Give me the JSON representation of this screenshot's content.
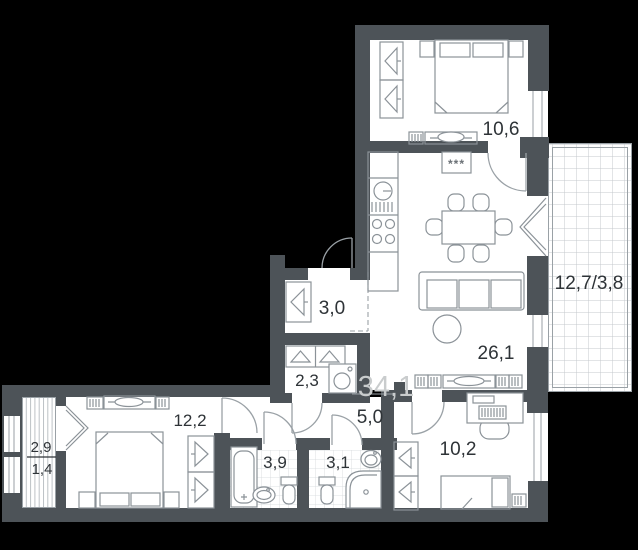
{
  "plan": {
    "title": "apartment-floor-plan",
    "total_area_label": "34,1",
    "labels": {
      "bedroom_top": "10,6",
      "loggia_right": "12,7/3,8",
      "closet": "3,0",
      "kitchen_living": "26,1",
      "wardrobe_room": "2,3",
      "total_area": "34,1",
      "bedroom_left": "12,2",
      "hallway": "5,0",
      "loggia_left_top": "2,9",
      "loggia_left_bottom": "1,4",
      "bathroom": "3,9",
      "toilet_room": "3,1",
      "bedroom_right": "10,2",
      "vent": "***"
    },
    "colors": {
      "background": "#000000",
      "wall": "#4d5358",
      "floor": "#ffffff",
      "furniture_line": "#8b9298",
      "grid_line": "#c4c9cc",
      "label_text": "#2e3337",
      "total_area_text": "#c9cccd"
    }
  }
}
